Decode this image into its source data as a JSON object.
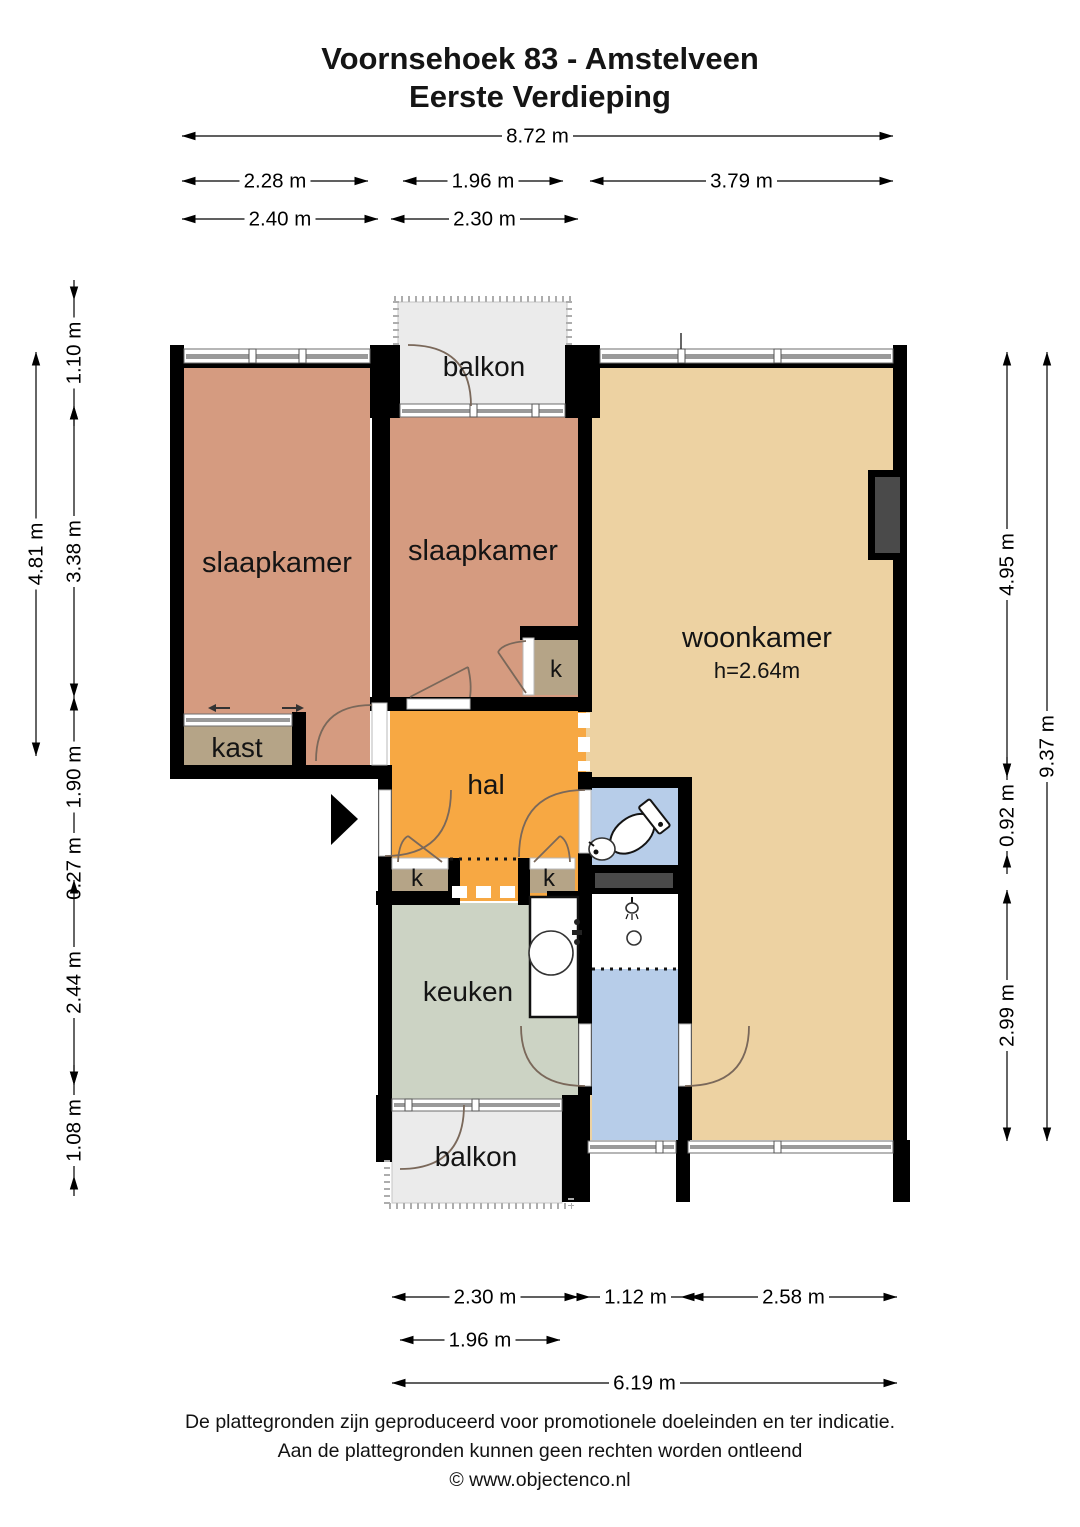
{
  "title": {
    "line1": "Voornsehoek 83 - Amstelveen",
    "line2": "Eerste Verdieping"
  },
  "footer": {
    "line1": "De plattegronden zijn geproduceerd voor promotionele doeleinden en ter indicatie.",
    "line2": "Aan de plattegronden kunnen geen rechten worden ontleend",
    "line3": "© www.objectenco.nl"
  },
  "rooms": [
    {
      "name": "slaapkamer-left",
      "label": "slaapkamer",
      "x": 277,
      "y": 572,
      "size": 29
    },
    {
      "name": "slaapkamer-middle",
      "label": "slaapkamer",
      "x": 483,
      "y": 560,
      "size": 29
    },
    {
      "name": "woonkamer",
      "label": "woonkamer",
      "x": 757,
      "y": 647,
      "size": 29
    },
    {
      "name": "woonkamer-ceiling-height",
      "label": "h=2.64m",
      "x": 757,
      "y": 678,
      "size": 22
    },
    {
      "name": "balkon-top",
      "label": "balkon",
      "x": 484,
      "y": 376,
      "size": 28
    },
    {
      "name": "kast",
      "label": "kast",
      "x": 237,
      "y": 757,
      "size": 28
    },
    {
      "name": "hal",
      "label": "hal",
      "x": 486,
      "y": 794,
      "size": 28
    },
    {
      "name": "closet-top",
      "label": "k",
      "x": 556,
      "y": 677,
      "size": 24
    },
    {
      "name": "closet-left",
      "label": "k",
      "x": 417,
      "y": 886,
      "size": 24
    },
    {
      "name": "closet-right",
      "label": "k",
      "x": 549,
      "y": 886,
      "size": 24
    },
    {
      "name": "keuken",
      "label": "keuken",
      "x": 468,
      "y": 1001,
      "size": 28
    },
    {
      "name": "balkon-bottom",
      "label": "balkon",
      "x": 476,
      "y": 1166,
      "size": 28
    }
  ],
  "dimensions": {
    "horizontal": [
      {
        "label": "8.72 m",
        "x1": 182,
        "x2": 893,
        "y": 136
      },
      {
        "label": "2.28 m",
        "x1": 182,
        "x2": 368,
        "y": 181
      },
      {
        "label": "1.96 m",
        "x1": 403,
        "x2": 563,
        "y": 181
      },
      {
        "label": "3.79 m",
        "x1": 590,
        "x2": 893,
        "y": 181
      },
      {
        "label": "2.40 m",
        "x1": 182,
        "x2": 378,
        "y": 219
      },
      {
        "label": "2.30 m",
        "x1": 391,
        "x2": 578,
        "y": 219
      },
      {
        "label": "2.30 m",
        "x1": 392,
        "x2": 578,
        "y": 1297
      },
      {
        "label": "1.12 m",
        "x1": 590,
        "x2": 681,
        "y": 1297
      },
      {
        "label": "2.58 m",
        "x1": 690,
        "x2": 897,
        "y": 1297
      },
      {
        "label": "1.96 m",
        "x1": 400,
        "x2": 560,
        "y": 1340
      },
      {
        "label": "6.19 m",
        "x1": 392,
        "x2": 897,
        "y": 1383
      }
    ],
    "vertical": [
      {
        "label": "4.81 m",
        "x": 36,
        "y1": 352,
        "y2": 756
      },
      {
        "label": "1.10 m",
        "x": 74,
        "y1": 300,
        "y2": 406
      },
      {
        "label": "3.38 m",
        "x": 74,
        "y1": 406,
        "y2": 697
      },
      {
        "label": "1.90 m",
        "x": 74,
        "y1": 697,
        "y2": 857
      },
      {
        "label": "0.27 m",
        "x": 74,
        "y1": 857,
        "y2": 880
      },
      {
        "label": "2.44 m",
        "x": 74,
        "y1": 880,
        "y2": 1085
      },
      {
        "label": "1.08 m",
        "x": 74,
        "y1": 1085,
        "y2": 1176
      },
      {
        "label": "4.95 m",
        "x": 1007,
        "y1": 352,
        "y2": 777
      },
      {
        "label": "0.92 m",
        "x": 1007,
        "y1": 777,
        "y2": 854
      },
      {
        "label": "2.99 m",
        "x": 1007,
        "y1": 890,
        "y2": 1141
      },
      {
        "label": "9.37 m",
        "x": 1047,
        "y1": 352,
        "y2": 1141
      }
    ]
  },
  "colors": {
    "bedroom": "#d59b80",
    "living": "#edd2a2",
    "hall": "#f7a843",
    "closet": "#b5a487",
    "kitchen": "#ccd3c4",
    "bathroom": "#b7cde9",
    "balcony": "#ebebeb",
    "wall": "#000000",
    "niche": "#4a4a4a",
    "counter": "#4a4a4a",
    "door_arc": "#7a685a"
  }
}
